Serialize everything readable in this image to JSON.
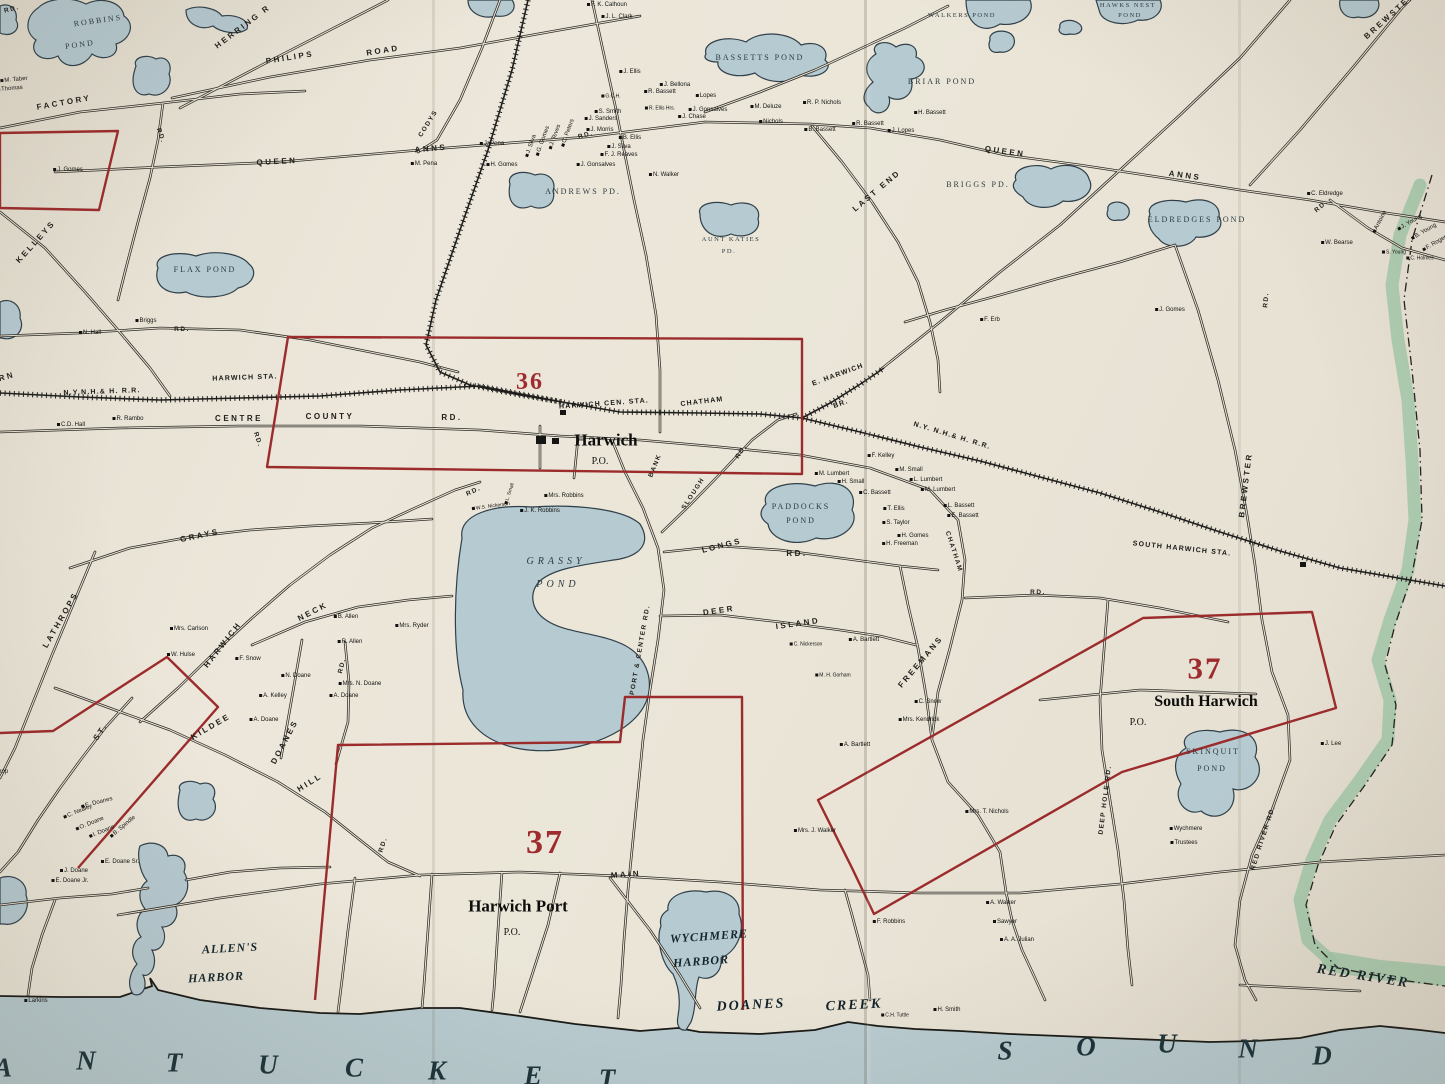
{
  "palette": {
    "paper": "#ebe6d8",
    "water": "#b8cbd0",
    "pond": "#b6cad1",
    "district_red": "#9c2b2c",
    "river_green": "#a3c9aa",
    "ink": "#1d1c1a"
  },
  "map": {
    "labels": [
      {
        "t": "RD.",
        "x": 12,
        "y": 10,
        "c": "rs",
        "r": -15
      },
      {
        "t": "HERRING R",
        "x": 243,
        "y": 27,
        "c": "rd8",
        "r": -37
      },
      {
        "t": "PHILIPS",
        "x": 290,
        "y": 58,
        "c": "rd8",
        "r": -9
      },
      {
        "t": "ROAD",
        "x": 383,
        "y": 51,
        "c": "rd8",
        "r": -9
      },
      {
        "t": "FACTORY",
        "x": 64,
        "y": 103,
        "c": "rd8",
        "r": -10
      },
      {
        "t": "RD.",
        "x": 160,
        "y": 136,
        "c": "rs",
        "r": 70
      },
      {
        "t": "QUEEN",
        "x": 277,
        "y": 162,
        "c": "rd8",
        "r": -3
      },
      {
        "t": "ANNS",
        "x": 431,
        "y": 149,
        "c": "rd8",
        "r": -5
      },
      {
        "t": "CODYS",
        "x": 429,
        "y": 124,
        "c": "rs",
        "r": -58
      },
      {
        "t": "KELLEYS",
        "x": 36,
        "y": 242,
        "c": "rd8",
        "r": -48
      },
      {
        "t": "QUEEN",
        "x": 1005,
        "y": 152,
        "c": "rd8",
        "r": 8
      },
      {
        "t": "ANNS",
        "x": 1185,
        "y": 176,
        "c": "rd8",
        "r": 8
      },
      {
        "t": "RD.",
        "x": 1322,
        "y": 207,
        "c": "rs",
        "r": -40
      },
      {
        "t": "RD.",
        "x": 1267,
        "y": 300,
        "c": "rs",
        "r": -85
      },
      {
        "t": "LAST END",
        "x": 877,
        "y": 191,
        "c": "rd8",
        "r": -40
      },
      {
        "t": "CENTRE",
        "x": 239,
        "y": 419,
        "c": "rd8"
      },
      {
        "t": "COUNTY",
        "x": 330,
        "y": 417,
        "c": "rd8"
      },
      {
        "t": "RD.",
        "x": 452,
        "y": 418,
        "c": "rd8"
      },
      {
        "t": "GRAYS",
        "x": 200,
        "y": 536,
        "c": "rd8",
        "r": -12
      },
      {
        "t": "BANK",
        "x": 656,
        "y": 466,
        "c": "rs",
        "r": -68
      },
      {
        "t": "SLOUGH",
        "x": 694,
        "y": 494,
        "c": "rs",
        "r": -57
      },
      {
        "t": "RD.",
        "x": 742,
        "y": 452,
        "c": "rs",
        "r": -57
      },
      {
        "t": "PORT & CENTER RD.",
        "x": 641,
        "y": 650,
        "c": "rs",
        "r": -80
      },
      {
        "t": "LONGS",
        "x": 722,
        "y": 546,
        "c": "rd8",
        "r": -14
      },
      {
        "t": "RD.",
        "x": 797,
        "y": 554,
        "c": "rd8"
      },
      {
        "t": "DEER",
        "x": 719,
        "y": 611,
        "c": "rd8",
        "r": -8
      },
      {
        "t": "ISLAND",
        "x": 798,
        "y": 624,
        "c": "rd8",
        "r": -8
      },
      {
        "t": "FREEMANS",
        "x": 921,
        "y": 662,
        "c": "rd8",
        "r": -50
      },
      {
        "t": "CHATHAM",
        "x": 953,
        "y": 552,
        "c": "rs",
        "r": 72
      },
      {
        "t": "RD.",
        "x": 1038,
        "y": 593,
        "c": "rs"
      },
      {
        "t": "DEEP HOLE RD.",
        "x": 1106,
        "y": 800,
        "c": "rs",
        "r": -83
      },
      {
        "t": "RED RIVER RD.",
        "x": 1264,
        "y": 838,
        "c": "rs",
        "r": -72
      },
      {
        "t": "MAIN",
        "x": 626,
        "y": 875,
        "c": "rd8",
        "r": -4
      },
      {
        "t": "KILDEE",
        "x": 211,
        "y": 727,
        "c": "rd8",
        "r": -30
      },
      {
        "t": "DOANES",
        "x": 285,
        "y": 742,
        "c": "rd8",
        "r": -62
      },
      {
        "t": "HILL",
        "x": 310,
        "y": 783,
        "c": "rd8",
        "r": -32
      },
      {
        "t": "RD.",
        "x": 384,
        "y": 845,
        "c": "rs",
        "r": -72
      },
      {
        "t": "ST.",
        "x": 101,
        "y": 732,
        "c": "rd8",
        "r": -55
      },
      {
        "t": "LATHROPS",
        "x": 61,
        "y": 620,
        "c": "rd8",
        "r": -60
      },
      {
        "t": "NECK",
        "x": 313,
        "y": 612,
        "c": "rd8",
        "r": -27
      },
      {
        "t": "HARWICH",
        "x": 223,
        "y": 645,
        "c": "rd8",
        "r": -52
      },
      {
        "t": "RD.",
        "x": 343,
        "y": 666,
        "c": "rs",
        "r": -75
      },
      {
        "t": "BREWSTER",
        "x": 1246,
        "y": 485,
        "c": "rd8",
        "r": -83
      },
      {
        "t": "BREWSTER",
        "x": 1390,
        "y": 16,
        "c": "rd8",
        "r": -42
      },
      {
        "t": "RN",
        "x": 7,
        "y": 377,
        "c": "rd8",
        "r": -15
      },
      {
        "t": "N.Y.N.H.& H. R.R.",
        "x": 102,
        "y": 392,
        "c": "st",
        "r": -2
      },
      {
        "t": "HARWICH STA.",
        "x": 245,
        "y": 378,
        "c": "st",
        "r": -2
      },
      {
        "t": "HARWICH CEN. STA.",
        "x": 604,
        "y": 404,
        "c": "st",
        "r": -4
      },
      {
        "t": "CHATHAM",
        "x": 702,
        "y": 402,
        "c": "st",
        "r": -7
      },
      {
        "t": "E. HARWICH",
        "x": 838,
        "y": 375,
        "c": "st",
        "r": -20
      },
      {
        "t": "BR.",
        "x": 841,
        "y": 404,
        "c": "st",
        "r": -20
      },
      {
        "t": "N.Y. N.H.& H. R.R.",
        "x": 952,
        "y": 436,
        "c": "st",
        "r": 17
      },
      {
        "t": "SOUTH HARWICH STA.",
        "x": 1182,
        "y": 549,
        "c": "st",
        "r": 6
      },
      {
        "t": "ROBBINS",
        "x": 98,
        "y": 21,
        "c": "pd",
        "r": -8
      },
      {
        "t": "POND",
        "x": 80,
        "y": 45,
        "c": "pd",
        "r": -8
      },
      {
        "t": "FLAX POND",
        "x": 205,
        "y": 270,
        "c": "pd"
      },
      {
        "t": "WALKERS POND",
        "x": 962,
        "y": 16,
        "c": "pd7"
      },
      {
        "t": "HAWKS NEST",
        "x": 1128,
        "y": 6,
        "c": "pd7"
      },
      {
        "t": "POND",
        "x": 1130,
        "y": 16,
        "c": "pd7"
      },
      {
        "t": "BASSETTS POND",
        "x": 760,
        "y": 58,
        "c": "pd"
      },
      {
        "t": "BRIAR POND",
        "x": 942,
        "y": 82,
        "c": "pd"
      },
      {
        "t": "BRIGGS PD.",
        "x": 978,
        "y": 185,
        "c": "pd"
      },
      {
        "t": "ELDREDGES POND",
        "x": 1197,
        "y": 220,
        "c": "pd"
      },
      {
        "t": "ANDREWS PD.",
        "x": 583,
        "y": 192,
        "c": "pd"
      },
      {
        "t": "AUNT KATIES",
        "x": 731,
        "y": 240,
        "c": "pd7"
      },
      {
        "t": "PD.",
        "x": 729,
        "y": 252,
        "c": "pd7"
      },
      {
        "t": "GRASSY",
        "x": 556,
        "y": 562,
        "c": "pdBig"
      },
      {
        "t": "POND",
        "x": 558,
        "y": 585,
        "c": "pdBig"
      },
      {
        "t": "PADDOCKS",
        "x": 801,
        "y": 507,
        "c": "pd"
      },
      {
        "t": "POND",
        "x": 801,
        "y": 521,
        "c": "pd"
      },
      {
        "t": "SKINQUIT",
        "x": 1213,
        "y": 752,
        "c": "pd"
      },
      {
        "t": "POND",
        "x": 1212,
        "y": 769,
        "c": "pd"
      },
      {
        "t": "Harwich",
        "x": 606,
        "y": 440,
        "c": "town",
        "s": 17
      },
      {
        "t": "P.O.",
        "x": 600,
        "y": 462,
        "c": "po"
      },
      {
        "t": "Harwich Port",
        "x": 518,
        "y": 906,
        "c": "town",
        "s": 17
      },
      {
        "t": "P.O.",
        "x": 512,
        "y": 933,
        "c": "po"
      },
      {
        "t": "South Harwich",
        "x": 1206,
        "y": 702,
        "c": "town",
        "s": 16
      },
      {
        "t": "P.O.",
        "x": 1138,
        "y": 723,
        "c": "po"
      },
      {
        "t": "36",
        "x": 530,
        "y": 382,
        "c": "dist",
        "s": 24
      },
      {
        "t": "37",
        "x": 545,
        "y": 843,
        "c": "dist",
        "s": 34
      },
      {
        "t": "37",
        "x": 1205,
        "y": 668,
        "c": "dist",
        "s": 31
      },
      {
        "t": "ALLEN'S",
        "x": 230,
        "y": 948,
        "c": "wm",
        "r": -3
      },
      {
        "t": "HARBOR",
        "x": 216,
        "y": 977,
        "c": "wm",
        "r": -3
      },
      {
        "t": "WYCHMERE",
        "x": 709,
        "y": 936,
        "c": "wm",
        "r": -4
      },
      {
        "t": "HARBOR",
        "x": 701,
        "y": 961,
        "c": "wm",
        "r": -4
      },
      {
        "t": "DOANES",
        "x": 751,
        "y": 1006,
        "c": "wb",
        "r": -3
      },
      {
        "t": "CREEK",
        "x": 854,
        "y": 1006,
        "c": "wb",
        "r": -3
      },
      {
        "t": "RED RIVER",
        "x": 1363,
        "y": 977,
        "c": "wb",
        "r": 9
      },
      {
        "t": "M. Taber",
        "x": 14,
        "y": 80,
        "r": -5
      },
      {
        "t": "Thomas",
        "x": 10,
        "y": 89,
        "r": -5
      },
      {
        "t": "J. Gomes",
        "x": 68,
        "y": 170
      },
      {
        "t": "M. Pena",
        "x": 424,
        "y": 164
      },
      {
        "t": "F. K. Calhoun",
        "x": 607,
        "y": 5
      },
      {
        "t": "J. L. Clark",
        "x": 617,
        "y": 17
      },
      {
        "t": "J. Ellis",
        "x": 630,
        "y": 72
      },
      {
        "t": "J. Bellona",
        "x": 675,
        "y": 85
      },
      {
        "t": "R. Bassett",
        "x": 660,
        "y": 92
      },
      {
        "t": "Lopes",
        "x": 706,
        "y": 96
      },
      {
        "t": "G.C.H.",
        "x": 611,
        "y": 97,
        "s": 5
      },
      {
        "t": "S. Smith",
        "x": 608,
        "y": 112
      },
      {
        "t": "J. Sanders",
        "x": 601,
        "y": 119
      },
      {
        "t": "J. Morris",
        "x": 600,
        "y": 130
      },
      {
        "t": "R. Ellis Hrs.",
        "x": 660,
        "y": 109,
        "s": 5
      },
      {
        "t": "J. Gonsalves",
        "x": 708,
        "y": 110
      },
      {
        "t": "J. Chase",
        "x": 692,
        "y": 117
      },
      {
        "t": "M. Deluze",
        "x": 766,
        "y": 107
      },
      {
        "t": "Nichols",
        "x": 771,
        "y": 122
      },
      {
        "t": "R. P. Nichols",
        "x": 822,
        "y": 103
      },
      {
        "t": "B. Bassett",
        "x": 820,
        "y": 130
      },
      {
        "t": "H. Bassett",
        "x": 930,
        "y": 113
      },
      {
        "t": "R. Bassett",
        "x": 868,
        "y": 124
      },
      {
        "t": "J. Lopes",
        "x": 901,
        "y": 131
      },
      {
        "t": "J. Pena",
        "x": 492,
        "y": 144
      },
      {
        "t": "H. Gomes",
        "x": 502,
        "y": 165
      },
      {
        "t": "J. Silva",
        "x": 531,
        "y": 146,
        "r": -70
      },
      {
        "t": "G. Gomes",
        "x": 543,
        "y": 141,
        "r": -70
      },
      {
        "t": "J. Teves",
        "x": 555,
        "y": 137,
        "r": -70
      },
      {
        "t": "C. Peters",
        "x": 568,
        "y": 133,
        "r": -70
      },
      {
        "t": "RD.",
        "x": 586,
        "y": 136,
        "c": "rs",
        "r": -15
      },
      {
        "t": "B. Ellis",
        "x": 630,
        "y": 138
      },
      {
        "t": "J. Silva",
        "x": 619,
        "y": 147
      },
      {
        "t": "F. J. Reaves",
        "x": 619,
        "y": 155
      },
      {
        "t": "J. Gonsalves",
        "x": 596,
        "y": 165
      },
      {
        "t": "N. Walker",
        "x": 664,
        "y": 175
      },
      {
        "t": "N. Hall",
        "x": 90,
        "y": 333
      },
      {
        "t": "Briggs",
        "x": 146,
        "y": 321
      },
      {
        "t": "RD.",
        "x": 182,
        "y": 330,
        "c": "rs"
      },
      {
        "t": "C.D. Hall",
        "x": 71,
        "y": 425
      },
      {
        "t": "R. Rambo",
        "x": 128,
        "y": 419
      },
      {
        "t": "RD.",
        "x": 257,
        "y": 440,
        "c": "rs",
        "r": 72
      },
      {
        "t": "F. Erb",
        "x": 990,
        "y": 320
      },
      {
        "t": "J. Gomes",
        "x": 1170,
        "y": 310
      },
      {
        "t": "C. Eldredge",
        "x": 1325,
        "y": 194
      },
      {
        "t": "W. Bearse",
        "x": 1337,
        "y": 243
      },
      {
        "t": "Antoine",
        "x": 1380,
        "y": 222,
        "r": -62
      },
      {
        "t": "J. Young",
        "x": 1410,
        "y": 223,
        "r": -30
      },
      {
        "t": "B. Young",
        "x": 1424,
        "y": 232,
        "r": -30
      },
      {
        "t": "F. Rogers",
        "x": 1436,
        "y": 243,
        "r": -30
      },
      {
        "t": "S. Young",
        "x": 1394,
        "y": 253,
        "s": 5
      },
      {
        "t": "C. Holmes",
        "x": 1420,
        "y": 259,
        "s": 5
      },
      {
        "t": "M. Lumbert",
        "x": 832,
        "y": 474
      },
      {
        "t": "H. Small",
        "x": 851,
        "y": 482
      },
      {
        "t": "C. Bassett",
        "x": 875,
        "y": 493
      },
      {
        "t": "F. Kelley",
        "x": 881,
        "y": 456
      },
      {
        "t": "M. Small",
        "x": 909,
        "y": 470
      },
      {
        "t": "L. Lumbert",
        "x": 926,
        "y": 480
      },
      {
        "t": "M. Lumbert",
        "x": 938,
        "y": 490
      },
      {
        "t": "T. Ellis",
        "x": 894,
        "y": 509
      },
      {
        "t": "S. Taylor",
        "x": 896,
        "y": 523
      },
      {
        "t": "L. Bassett",
        "x": 959,
        "y": 506
      },
      {
        "t": "E. Bassett",
        "x": 963,
        "y": 516
      },
      {
        "t": "H. Gomes",
        "x": 913,
        "y": 536
      },
      {
        "t": "H. Freeman",
        "x": 900,
        "y": 544
      },
      {
        "t": "Mrs. Robbins",
        "x": 564,
        "y": 496
      },
      {
        "t": "J. K. Robbins",
        "x": 540,
        "y": 511
      },
      {
        "t": "W.S. Nickerson",
        "x": 491,
        "y": 507,
        "s": 5,
        "r": -8
      },
      {
        "t": "L. Small",
        "x": 510,
        "y": 494,
        "s": 5,
        "r": -72
      },
      {
        "t": "RD.",
        "x": 474,
        "y": 492,
        "c": "rs",
        "r": -25
      },
      {
        "t": "Mrs. Ryder",
        "x": 412,
        "y": 626
      },
      {
        "t": "Mrs. Carlson",
        "x": 189,
        "y": 629
      },
      {
        "t": "W. Hulse",
        "x": 181,
        "y": 655
      },
      {
        "t": "F. Snow",
        "x": 248,
        "y": 659
      },
      {
        "t": "B. Allen",
        "x": 346,
        "y": 617
      },
      {
        "t": "R. Allen",
        "x": 350,
        "y": 642
      },
      {
        "t": "N. Doane",
        "x": 296,
        "y": 676
      },
      {
        "t": "Mrs. N. Doane",
        "x": 360,
        "y": 684
      },
      {
        "t": "A. Kelley",
        "x": 273,
        "y": 696
      },
      {
        "t": "A. Doane",
        "x": 344,
        "y": 696
      },
      {
        "t": "A. Doane",
        "x": 264,
        "y": 720
      },
      {
        "t": "C. Nickerson",
        "x": 806,
        "y": 645,
        "s": 5
      },
      {
        "t": "M. H. Gorham",
        "x": 833,
        "y": 676,
        "s": 5
      },
      {
        "t": "A. Bartlett",
        "x": 864,
        "y": 640
      },
      {
        "t": "C. Snow",
        "x": 928,
        "y": 702
      },
      {
        "t": "Mrs. Kendrick",
        "x": 919,
        "y": 720
      },
      {
        "t": "A. Bartlett",
        "x": 855,
        "y": 745
      },
      {
        "t": "Mrs. T. Nichols",
        "x": 987,
        "y": 812
      },
      {
        "t": "Wychmere",
        "x": 1186,
        "y": 829
      },
      {
        "t": "Trustees",
        "x": 1184,
        "y": 843
      },
      {
        "t": "J. Lee",
        "x": 1331,
        "y": 744
      },
      {
        "t": "Mrs. J. Walker",
        "x": 815,
        "y": 831
      },
      {
        "t": "F. Robbins",
        "x": 889,
        "y": 922
      },
      {
        "t": "A. Walker",
        "x": 1001,
        "y": 903
      },
      {
        "t": "Sawyer",
        "x": 1005,
        "y": 922
      },
      {
        "t": "A. A. Julian",
        "x": 1017,
        "y": 940
      },
      {
        "t": "C.H. Tuttle",
        "x": 895,
        "y": 1016,
        "s": 5
      },
      {
        "t": "H. Smith",
        "x": 947,
        "y": 1010
      },
      {
        "t": "Larkins",
        "x": 36,
        "y": 1001
      },
      {
        "t": "C. Nealey",
        "x": 78,
        "y": 812,
        "r": -22
      },
      {
        "t": "O. Doane",
        "x": 90,
        "y": 824,
        "r": -22
      },
      {
        "t": "I. Doane",
        "x": 102,
        "y": 832,
        "r": -22
      },
      {
        "t": "B. Spindle",
        "x": 123,
        "y": 827,
        "r": -40
      },
      {
        "t": "E. Doanes",
        "x": 97,
        "y": 803,
        "r": -15
      },
      {
        "t": "E. Doane Sr.",
        "x": 120,
        "y": 862
      },
      {
        "t": "J. Doane",
        "x": 74,
        "y": 871
      },
      {
        "t": "E. Doane Jr.",
        "x": 70,
        "y": 881
      },
      {
        "t": "Lathrop",
        "x": -4,
        "y": 772
      }
    ],
    "sea_letters": [
      {
        "t": "A",
        "x": 3,
        "y": 1068
      },
      {
        "t": "N",
        "x": 86,
        "y": 1061
      },
      {
        "t": "T",
        "x": 174,
        "y": 1063
      },
      {
        "t": "U",
        "x": 268,
        "y": 1065
      },
      {
        "t": "C",
        "x": 354,
        "y": 1068
      },
      {
        "t": "K",
        "x": 437,
        "y": 1071
      },
      {
        "t": "E",
        "x": 533,
        "y": 1076
      },
      {
        "t": "T",
        "x": 607,
        "y": 1079
      },
      {
        "t": "S",
        "x": 1005,
        "y": 1051
      },
      {
        "t": "O",
        "x": 1086,
        "y": 1047
      },
      {
        "t": "U",
        "x": 1167,
        "y": 1044
      },
      {
        "t": "N",
        "x": 1248,
        "y": 1049
      },
      {
        "t": "D",
        "x": 1322,
        "y": 1056
      }
    ]
  }
}
